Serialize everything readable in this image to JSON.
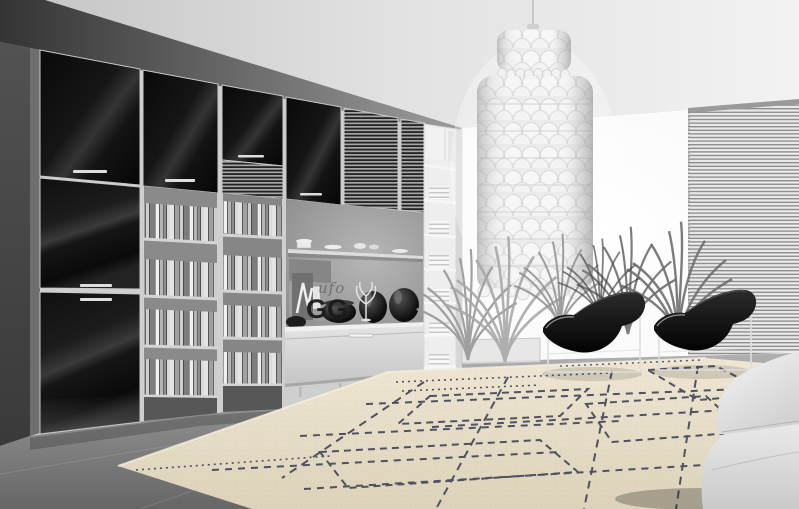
{
  "scene": {
    "watermark": {
      "script": "ufo",
      "main": "GG"
    }
  },
  "colors": {
    "ceiling-grey": "#d9d9d9",
    "wall-dark": "#3f3f3f",
    "wall-mid": "#9a9a9a",
    "window-white": "#fdfdfd",
    "floor-grey": "#8c8c8c",
    "cabinet-black": "#111111",
    "frame-silver": "#c9c9c9",
    "shelf-light": "#d4d4d4",
    "rug-base": "#e8e0cb",
    "rug-line": "#3f4358",
    "chair-black": "#0a0a0a",
    "chrome": "#dedede",
    "sofa-grey": "#dedede",
    "chandelier-white": "#f4f4f4",
    "plant-grey": "#8e8e8e"
  }
}
